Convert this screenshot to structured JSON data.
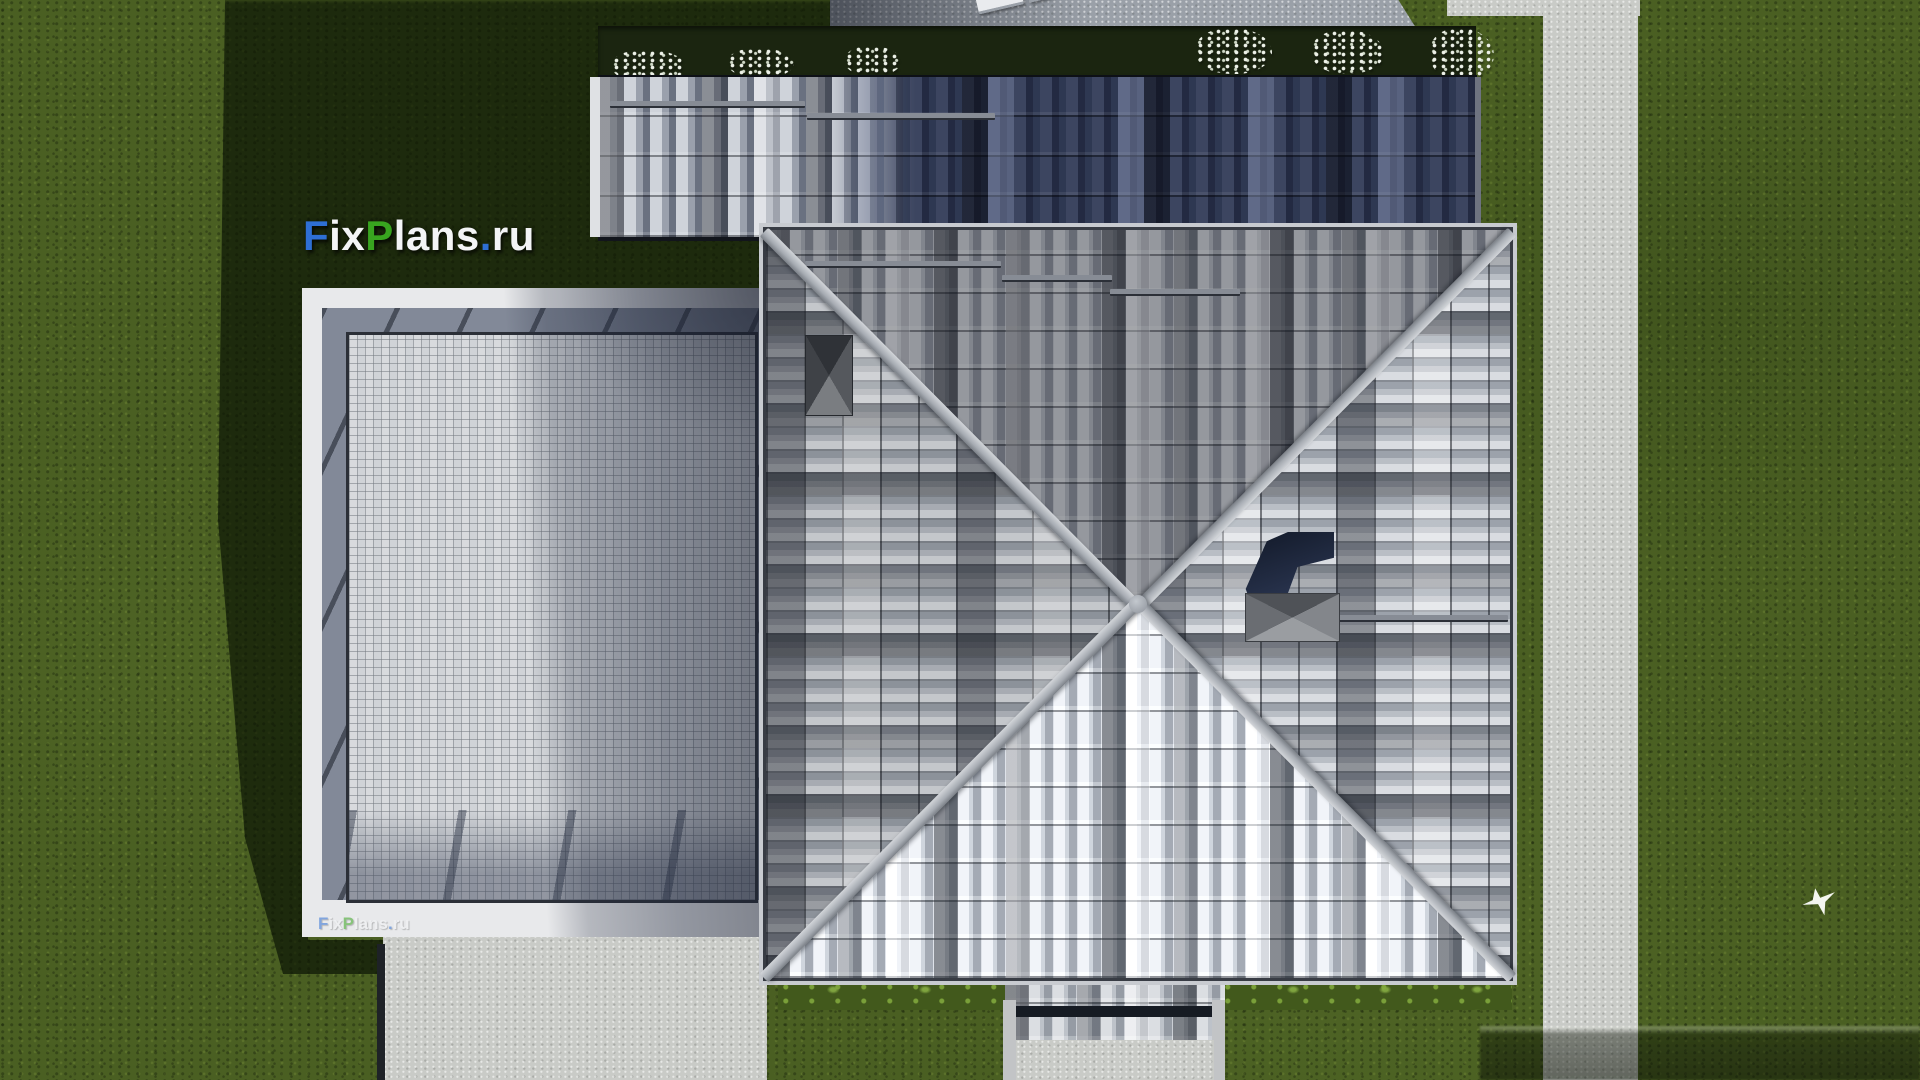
{
  "watermark": {
    "text": "FixPlans.ru",
    "segments": [
      {
        "text": "F",
        "color": "#2e6fd4"
      },
      {
        "text": "ix",
        "color": "#f3f4f6"
      },
      {
        "text": "P",
        "color": "#38a51f"
      },
      {
        "text": "lans",
        "color": "#f3f4f6"
      },
      {
        "text": ".",
        "color": "#2e6fd4"
      },
      {
        "text": "ru",
        "color": "#f3f4f6"
      }
    ]
  },
  "colors": {
    "brand_blue": "#2e6fd4",
    "brand_green": "#38a51f",
    "watermark_white": "#f3f4f6",
    "grass": "#4a5f22",
    "grass_shadow": "#16220b",
    "upper_roof_dark": "#252c42",
    "roof_tile_light": "#d7dade",
    "roof_tile_dark": "#82878f",
    "ridge_gray": "#a7acb3",
    "concrete_path": "#c9cbc7",
    "terrace_paving": "#d0d3d7",
    "lounger_blue": "#1f4ed8"
  }
}
